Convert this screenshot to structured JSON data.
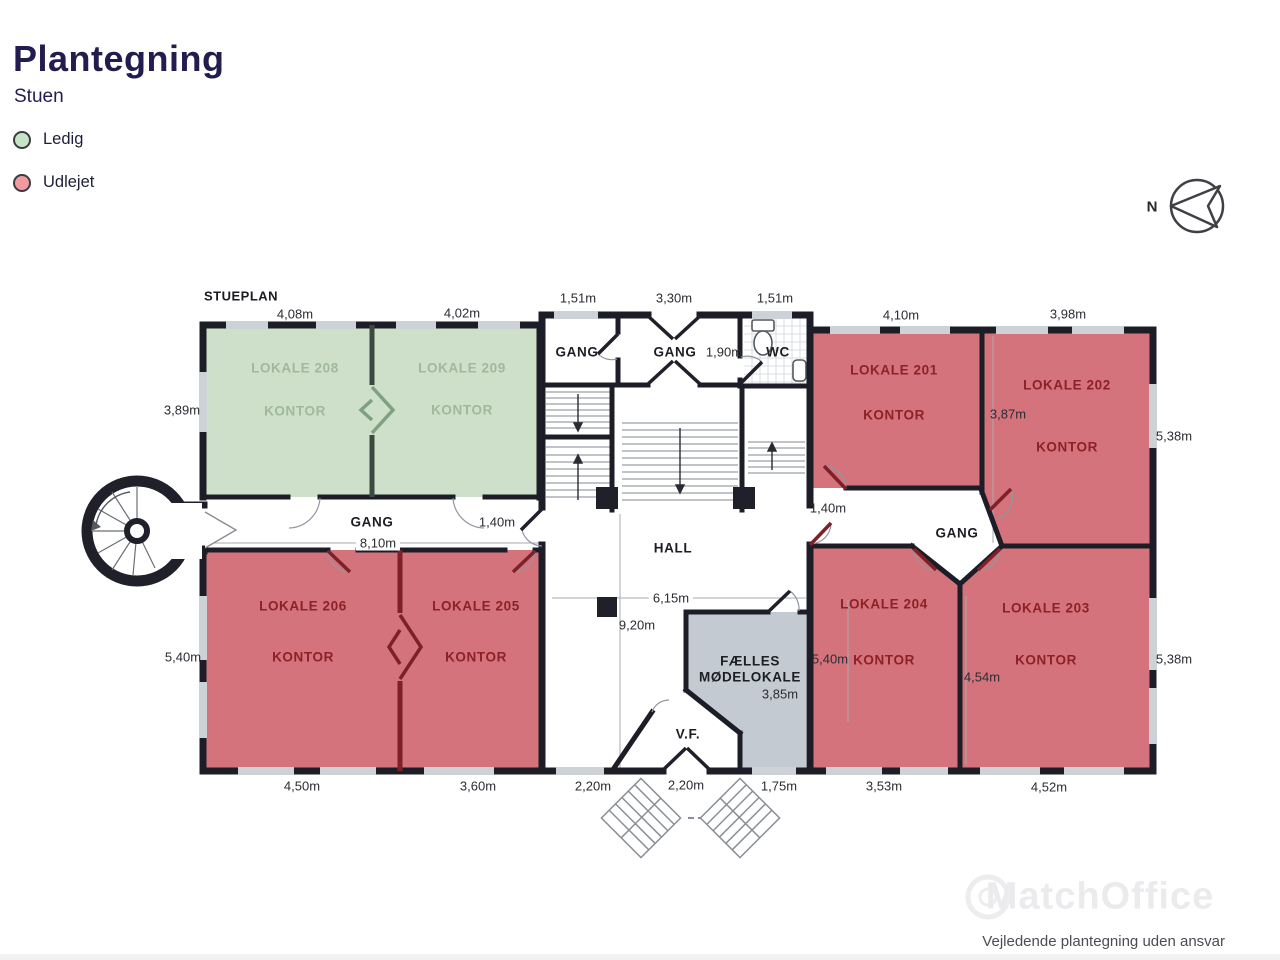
{
  "header": {
    "title": "Plantegning",
    "subtitle": "Stuen"
  },
  "legend": {
    "ledig": "Ledig",
    "udlejet": "Udlejet"
  },
  "compass": {
    "north": "N"
  },
  "plan": {
    "floor_label": "STUEPLAN",
    "rooms": {
      "lokale208": {
        "name": "LOKALE 208",
        "type": "KONTOR",
        "status": "ledig"
      },
      "lokale209": {
        "name": "LOKALE 209",
        "type": "KONTOR",
        "status": "ledig"
      },
      "lokale201": {
        "name": "LOKALE 201",
        "type": "KONTOR",
        "status": "udlejet"
      },
      "lokale202": {
        "name": "LOKALE 202",
        "type": "KONTOR",
        "status": "udlejet"
      },
      "lokale203": {
        "name": "LOKALE 203",
        "type": "KONTOR",
        "status": "udlejet"
      },
      "lokale204": {
        "name": "LOKALE 204",
        "type": "KONTOR",
        "status": "udlejet"
      },
      "lokale205": {
        "name": "LOKALE 205",
        "type": "KONTOR",
        "status": "udlejet"
      },
      "lokale206": {
        "name": "LOKALE 206",
        "type": "KONTOR",
        "status": "udlejet"
      }
    },
    "areas": {
      "gang_top_left": "GANG",
      "gang_top_mid": "GANG",
      "wc": "WC",
      "gang_west": "GANG",
      "hall": "HALL",
      "gang_east": "GANG",
      "meeting_line1": "FÆLLES",
      "meeting_line2": "MØDELOKALE",
      "vf": "V.F."
    },
    "dimensions": {
      "w208": "4,08m",
      "w209": "4,02m",
      "w_gang1": "1,51m",
      "w_gang2": "3,30m",
      "w_wc": "1,51m",
      "w201": "4,10m",
      "w202": "3,98m",
      "h208": "3,89m",
      "w_wc_inner": "1,90m",
      "h202_inner": "3,87m",
      "h202": "5,38m",
      "gang_length": "8,10m",
      "gang_door": "1,40m",
      "gang_east_door": "1,40m",
      "hall_width": "6,15m",
      "hall_height": "9,20m",
      "h206": "5,40m",
      "h204_inner": "5,40m",
      "h203_inner": "4,54m",
      "h203": "5,38m",
      "meeting_width": "3,85m",
      "w206": "4,50m",
      "w205": "3,60m",
      "w_hall_bottom": "2,20m",
      "w_vf": "2,20m",
      "w_meeting_bottom": "1,75m",
      "w204": "3,53m",
      "w203": "4,52m"
    }
  },
  "footer": {
    "watermark": "MatchOffice",
    "disclaimer": "Vejledende plantegning uden ansvar"
  },
  "colors": {
    "accent_navy": "#231c4f",
    "ledig_fill": "#cfe0ca",
    "udlejet_fill": "#d4737b",
    "meeting_fill": "#c4cad1",
    "wall": "#1d1d27",
    "legend_green": "#c6e5c6",
    "legend_red": "#f09aa0"
  }
}
